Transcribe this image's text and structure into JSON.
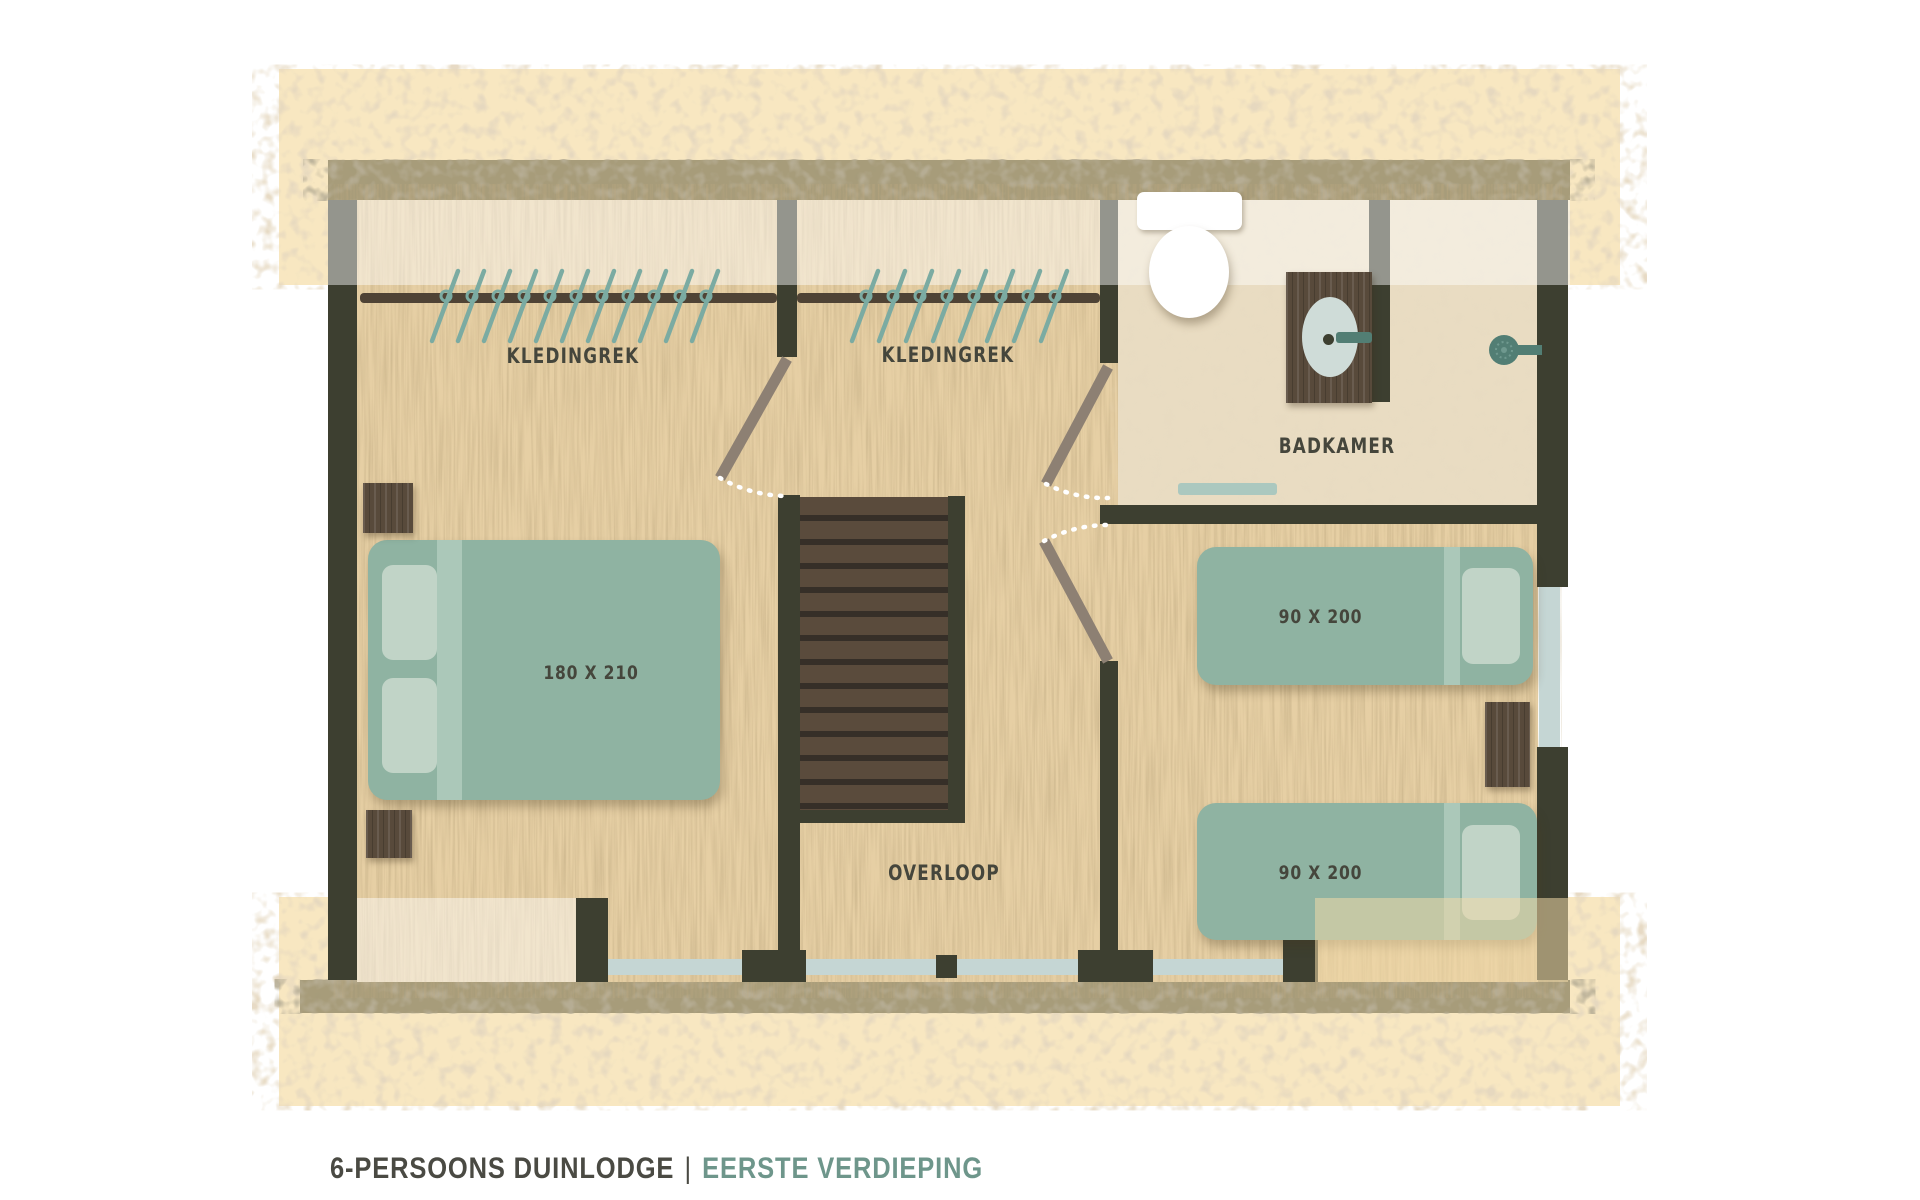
{
  "caption": {
    "main": "6-PERSOONS DUINLODGE",
    "separator": "|",
    "sub": "EERSTE VERDIEPING"
  },
  "rooms": {
    "closet_left": {
      "label": "KLEDINGREK"
    },
    "closet_right": {
      "label": "KLEDINGREK"
    },
    "bathroom": {
      "label": "BADKAMER"
    },
    "landing": {
      "label": "OVERLOOP"
    }
  },
  "furniture": {
    "double_bed": {
      "size_label": "180 X 210"
    },
    "single_bed_top": {
      "size_label": "90 X 200"
    },
    "single_bed_bottom": {
      "size_label": "90 X 200"
    }
  },
  "closets": {
    "left_hanger_count": 11,
    "right_hanger_count": 8
  },
  "icons": {
    "toilet": "toilet-icon",
    "sink": "sink-icon",
    "shower": "shower-head-icon",
    "hanger": "clothes-hanger-icon",
    "stairs": "stairs-icon",
    "door_swing": "door-swing-icon",
    "window": "window-icon"
  },
  "colors": {
    "sand": "#f8e7c1",
    "sand-speckle": "#c8b28a",
    "khaki": "#a29876",
    "wall": "#3d3f30",
    "wood": "#e6cfa4",
    "bath-floor": "#e9dcc2",
    "bed": "#8fb3a2",
    "pillow": "#c1d4c7",
    "fold": "#abc8b9",
    "window": "#c5d6d4",
    "mat": "#abc8bf",
    "rail": "#4f4335",
    "hanger": "#7baba2",
    "shower": "#527e74",
    "door": "#8d8073",
    "stair-light": "#5a4b3c",
    "stair-dark": "#362f28",
    "cab": "#584a3b",
    "basin": "#cfdcd8",
    "label": "#45463c",
    "cap-dark": "#4a4a43",
    "cap-teal": "#6e968b"
  }
}
